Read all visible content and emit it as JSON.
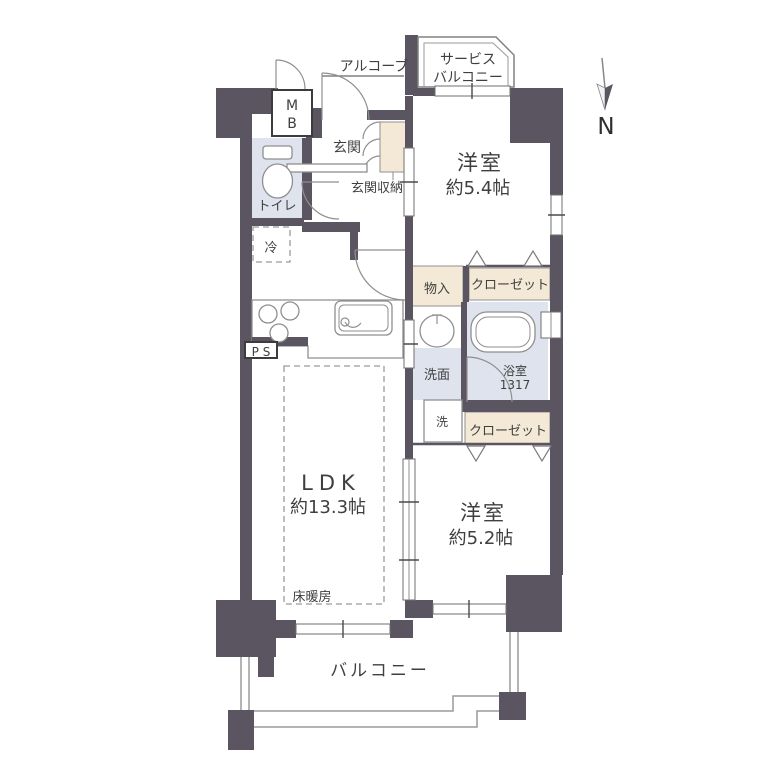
{
  "plan": {
    "type": "apartment-floor-plan",
    "compass": {
      "label": "N"
    },
    "colors": {
      "wall": "#5b5561",
      "closet_fill": "#f4e9d6",
      "wet_area_fill": "#dfe3ee",
      "outline": "#8f8f8f",
      "text": "#3f3f3f"
    },
    "labels": {
      "service_balcony_1": "サービス",
      "service_balcony_2": "バルコニー",
      "alcove": "アルコーブ",
      "meter_box_1": "M",
      "meter_box_2": "B",
      "entrance": "玄関",
      "entrance_storage": "玄関収納",
      "toilet": "トイレ",
      "refrigerator": "冷",
      "pipe_space": "P S",
      "storage": "物入",
      "closet_upper": "クローゼット",
      "closet_lower": "クローゼット",
      "washroom": "洗面",
      "bathroom_name": "浴室",
      "bathroom_size": "1317",
      "washer": "洗",
      "bedroom1_name": "洋室",
      "bedroom1_size": "約5.4帖",
      "bedroom2_name": "洋室",
      "bedroom2_size": "約5.2帖",
      "ldk_name": "LDK",
      "ldk_size": "約13.3帖",
      "floor_heating": "床暖房",
      "balcony": "バルコニー"
    }
  }
}
